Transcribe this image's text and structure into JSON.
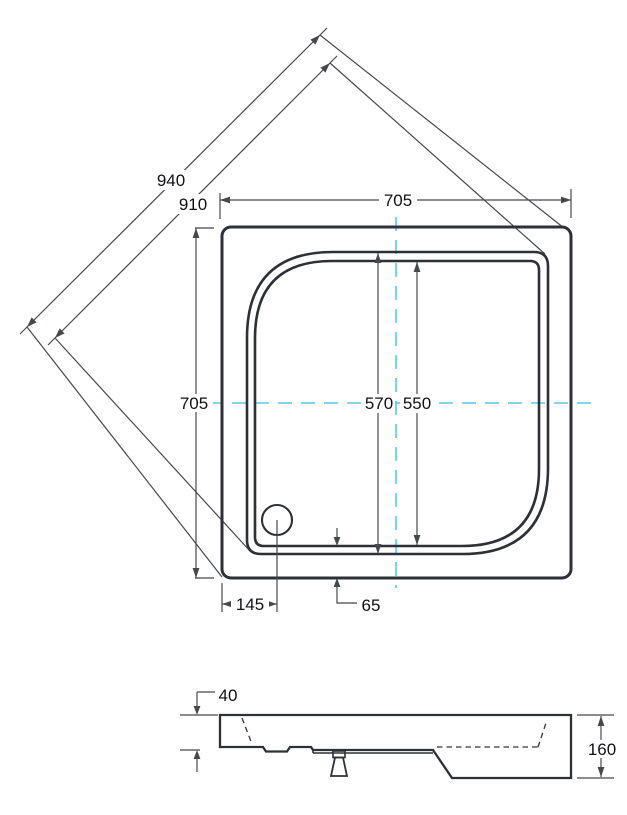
{
  "drawing": {
    "kind": "shower-tray technical drawing, plan view and side section",
    "colors": {
      "outline": "#2d3036",
      "dimension_lines": "#45484d",
      "centerline_accent": "#57c7ee",
      "label_text": "#101114",
      "background": "#ffffff"
    },
    "plan_view": {
      "labels": {
        "diagonal_outer": "940",
        "diagonal_inner": "910",
        "width_top": "705",
        "height_left": "705",
        "basin_span_outer": "570",
        "basin_span_inner": "550",
        "drain_offset": "145",
        "rim_to_edge_gap": "65"
      }
    },
    "side_view": {
      "labels": {
        "rim_height": "40",
        "total_height": "160"
      }
    }
  }
}
